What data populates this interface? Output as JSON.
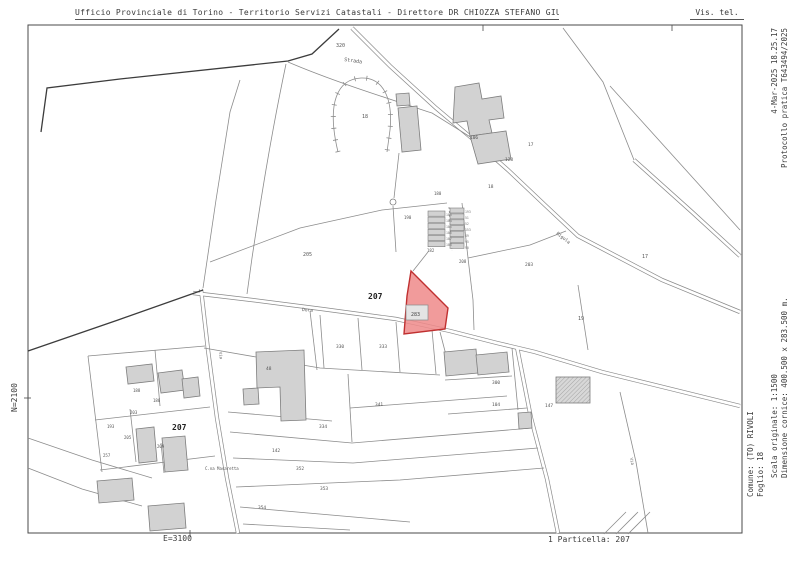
{
  "header": {
    "title": "Ufficio Provinciale di Torino - Territorio Servizi Catastali - Direttore DR CHIOZZA STEFANO GIUSEPPE",
    "right_label": "Vis. tel."
  },
  "right_margin": {
    "timestamp": "4-Mar-2025 18.25.17",
    "protocol": "Protocollo pratica T643494/2025",
    "scale": "Scala originale: 1:1500",
    "frame_size": "Dimensione cornice: 400.500 x 283.500 m.",
    "comune": "Comune: (TO) RIVOLI",
    "foglio": "Foglio: 18"
  },
  "left_margin": {
    "north_coord": "N=2100"
  },
  "bottom_margin": {
    "east_coord": "E=3100",
    "parcel_ref": "1 Particella: 207"
  },
  "map": {
    "highlight": {
      "parcel_number": "283",
      "fill": "#ef8a8a",
      "stroke": "#c03030"
    },
    "labels": [
      {
        "text": "320",
        "x": 336,
        "y": 47,
        "size": 5
      },
      {
        "text": "Strada",
        "x": 344,
        "y": 61,
        "size": 5,
        "angle": 8
      },
      {
        "text": "18",
        "x": 362,
        "y": 118,
        "size": 5
      },
      {
        "text": "106",
        "x": 470,
        "y": 139,
        "size": 4.5
      },
      {
        "text": "17",
        "x": 528,
        "y": 146,
        "size": 4.5
      },
      {
        "text": "128",
        "x": 505,
        "y": 161,
        "size": 4.5
      },
      {
        "text": "18",
        "x": 488,
        "y": 188,
        "size": 4.5
      },
      {
        "text": "17",
        "x": 642,
        "y": 258,
        "size": 5
      },
      {
        "text": "180",
        "x": 434,
        "y": 195,
        "size": 4
      },
      {
        "text": "190",
        "x": 404,
        "y": 219,
        "size": 4
      },
      {
        "text": "182",
        "x": 427,
        "y": 252,
        "size": 4
      },
      {
        "text": "208",
        "x": 459,
        "y": 263,
        "size": 4
      },
      {
        "text": "203",
        "x": 525,
        "y": 266,
        "size": 4.5
      },
      {
        "text": "205",
        "x": 303,
        "y": 256,
        "size": 5
      },
      {
        "text": "207",
        "x": 368,
        "y": 299,
        "size": 8,
        "bold": true,
        "color": "#222"
      },
      {
        "text": "283",
        "x": 411,
        "y": 316,
        "size": 5,
        "color": "#444"
      },
      {
        "text": "Dora",
        "x": 302,
        "y": 311,
        "size": 4.5,
        "angle": 4
      },
      {
        "text": "Rigola",
        "x": 556,
        "y": 234,
        "size": 4.5,
        "angle": 38
      },
      {
        "text": "19",
        "x": 578,
        "y": 320,
        "size": 5
      },
      {
        "text": "330",
        "x": 336,
        "y": 348,
        "size": 4.5
      },
      {
        "text": "333",
        "x": 379,
        "y": 348,
        "size": 4.5
      },
      {
        "text": "48",
        "x": 266,
        "y": 370,
        "size": 4.5
      },
      {
        "text": "300",
        "x": 492,
        "y": 384,
        "size": 4.5
      },
      {
        "text": "104",
        "x": 492,
        "y": 406,
        "size": 4.5
      },
      {
        "text": "147",
        "x": 545,
        "y": 407,
        "size": 4.5
      },
      {
        "text": "334",
        "x": 319,
        "y": 428,
        "size": 4.5
      },
      {
        "text": "341",
        "x": 375,
        "y": 406,
        "size": 4.5
      },
      {
        "text": "142",
        "x": 272,
        "y": 452,
        "size": 4.5
      },
      {
        "text": "352",
        "x": 296,
        "y": 470,
        "size": 4.5
      },
      {
        "text": "353",
        "x": 320,
        "y": 490,
        "size": 4.5
      },
      {
        "text": "354",
        "x": 258,
        "y": 509,
        "size": 4.5
      },
      {
        "text": "C.na Masaretta",
        "x": 205,
        "y": 470,
        "size": 4
      },
      {
        "text": "207",
        "x": 172,
        "y": 430,
        "size": 8,
        "bold": true,
        "color": "#222"
      },
      {
        "text": "188",
        "x": 133,
        "y": 392,
        "size": 4
      },
      {
        "text": "186",
        "x": 153,
        "y": 402,
        "size": 4
      },
      {
        "text": "203",
        "x": 130,
        "y": 414,
        "size": 4
      },
      {
        "text": "193",
        "x": 107,
        "y": 428,
        "size": 4
      },
      {
        "text": "205",
        "x": 124,
        "y": 439,
        "size": 4
      },
      {
        "text": "209",
        "x": 157,
        "y": 448,
        "size": 4
      },
      {
        "text": "257",
        "x": 103,
        "y": 457,
        "size": 4
      },
      {
        "text": "Via",
        "x": 219,
        "y": 352,
        "size": 4,
        "angle": 82
      },
      {
        "text": "Via",
        "x": 630,
        "y": 458,
        "size": 4,
        "angle": 78
      },
      {
        "text": "183",
        "x": 446,
        "y": 216,
        "size": 3.2,
        "color": "#777"
      },
      {
        "text": "184",
        "x": 446,
        "y": 222,
        "size": 3.2,
        "color": "#777"
      },
      {
        "text": "185",
        "x": 446,
        "y": 228,
        "size": 3.2,
        "color": "#777"
      },
      {
        "text": "186",
        "x": 446,
        "y": 234,
        "size": 3.2,
        "color": "#777"
      },
      {
        "text": "187",
        "x": 446,
        "y": 240,
        "size": 3.2,
        "color": "#777"
      },
      {
        "text": "188",
        "x": 446,
        "y": 246,
        "size": 3.2,
        "color": "#777"
      },
      {
        "text": "193",
        "x": 465,
        "y": 213,
        "size": 3.2,
        "color": "#777"
      },
      {
        "text": "51",
        "x": 465,
        "y": 219,
        "size": 3.2,
        "color": "#777"
      },
      {
        "text": "52",
        "x": 465,
        "y": 225,
        "size": 3.2,
        "color": "#777"
      },
      {
        "text": "153",
        "x": 465,
        "y": 231,
        "size": 3.2,
        "color": "#777"
      },
      {
        "text": "49",
        "x": 465,
        "y": 237,
        "size": 3.2,
        "color": "#777"
      },
      {
        "text": "95",
        "x": 465,
        "y": 243,
        "size": 3.2,
        "color": "#777"
      },
      {
        "text": "90",
        "x": 465,
        "y": 249,
        "size": 3.2,
        "color": "#777"
      }
    ]
  }
}
